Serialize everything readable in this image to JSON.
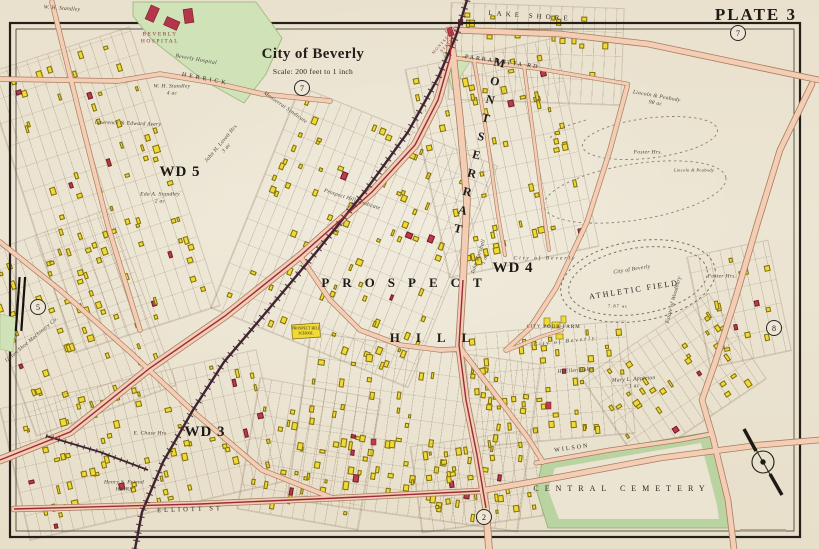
{
  "plate": {
    "label": "PLATE 3"
  },
  "title": {
    "name": "City of Beverly",
    "scale": "Scale: 200 feet to 1 inch"
  },
  "colors": {
    "paper": "#ece5d3",
    "road_fill": "#f3cdb4",
    "road_casing": "#a87d60",
    "building_wood": "#f1da33",
    "building_brick": "#bf3a4a",
    "park_green": "#cfe2b8",
    "cemetery_green": "#b9d4a0",
    "railroad": "#3f2430",
    "trolley": "#992b3d"
  },
  "plate_refs": [
    {
      "n": "7",
      "x": 738,
      "y": 33
    },
    {
      "n": "7",
      "x": 302,
      "y": 88
    },
    {
      "n": "5",
      "x": 38,
      "y": 307
    },
    {
      "n": "8",
      "x": 774,
      "y": 328
    },
    {
      "n": "2",
      "x": 484,
      "y": 517
    }
  ],
  "labels": {
    "districts": [
      {
        "t": "MONTSERRAT",
        "x": 478,
        "y": 148,
        "r": 14,
        "s": 12,
        "ls": 5,
        "v": true
      },
      {
        "t": "PROSPECT",
        "x": 408,
        "y": 283,
        "r": 0,
        "s": 13,
        "ls": 13
      },
      {
        "t": "HILL",
        "x": 438,
        "y": 338,
        "r": 0,
        "s": 13,
        "ls": 16
      }
    ],
    "wards": [
      {
        "t": "WD 5",
        "x": 180,
        "y": 172
      },
      {
        "t": "WD 4",
        "x": 513,
        "y": 268
      },
      {
        "t": "WD 3",
        "x": 205,
        "y": 432
      }
    ],
    "streets": [
      {
        "t": "LAKE SHORE",
        "x": 530,
        "y": 16,
        "r": 4,
        "s": 7,
        "ls": 4
      },
      {
        "t": "PARRAMATTA RD",
        "x": 502,
        "y": 63,
        "r": 8,
        "s": 6,
        "ls": 2
      },
      {
        "t": "HERRICK",
        "x": 205,
        "y": 80,
        "r": 11,
        "s": 6,
        "ls": 3
      },
      {
        "t": "ELLIOTT ST",
        "x": 190,
        "y": 510,
        "r": -2,
        "s": 6.5,
        "ls": 3
      },
      {
        "t": "WILSON",
        "x": 572,
        "y": 449,
        "r": -8,
        "s": 6,
        "ls": 2
      }
    ],
    "landmarks": [
      {
        "t": "BEVERLY\nHOSPITAL",
        "x": 160,
        "y": 38,
        "s": 5.5,
        "ls": 1.5,
        "red": true
      },
      {
        "t": "MONTSERRAT\nSTATION",
        "x": 447,
        "y": 41,
        "r": -48,
        "s": 4.2,
        "red": true
      },
      {
        "t": "CENTRAL  CEMETERY",
        "x": 622,
        "y": 489,
        "s": 8,
        "ls": 6
      },
      {
        "t": "CITY",
        "x": 534,
        "y": 326,
        "s": 4.5
      },
      {
        "t": "POOR FARM",
        "x": 562,
        "y": 328,
        "s": 5,
        "ls": 1
      },
      {
        "t": "ATHLETIC FIELD",
        "x": 634,
        "y": 290,
        "r": -9,
        "s": 8,
        "ls": 2
      },
      {
        "t": "PROSPECT HILL\nSCHOOL",
        "x": 306,
        "y": 331,
        "s": 3.8,
        "ls": 0
      },
      {
        "t": "7.87 ac",
        "x": 618,
        "y": 306,
        "s": 4.5
      }
    ],
    "owners": [
      {
        "t": "W. H. Standley",
        "x": 62,
        "y": 9,
        "r": 4
      },
      {
        "t": "W. H. Standley\n4 ac",
        "x": 172,
        "y": 90
      },
      {
        "t": "Beverly Hospital",
        "x": 196,
        "y": 60,
        "r": 10
      },
      {
        "t": "Lawrence & Edward Avery",
        "x": 128,
        "y": 124,
        "r": 2
      },
      {
        "t": "John H. Lovett Hrs\n3 ac",
        "x": 224,
        "y": 146,
        "r": -50
      },
      {
        "t": "Eda A. Standley\n2 ac",
        "x": 160,
        "y": 198
      },
      {
        "t": "Monserrat Syndicate",
        "x": 285,
        "y": 108,
        "r": 35
      },
      {
        "t": "Prospect Hill Syndicate",
        "x": 352,
        "y": 200,
        "r": 18
      },
      {
        "t": "John Marshall\n1 ac",
        "x": 482,
        "y": 258,
        "r": -72
      },
      {
        "t": "Lincoln & Peabody\n98 ac",
        "x": 656,
        "y": 100,
        "r": 10
      },
      {
        "t": "Foster Hrs.",
        "x": 648,
        "y": 153
      },
      {
        "t": "Lincoln & Peabody",
        "x": 694,
        "y": 170,
        "s": 4.5
      },
      {
        "t": "Foster Hrs.",
        "x": 722,
        "y": 277
      },
      {
        "t": "Estate of Woodbury",
        "x": 674,
        "y": 300,
        "r": -75
      },
      {
        "t": "City of Beverly",
        "x": 545,
        "y": 259,
        "ls": 2
      },
      {
        "t": "City of Beverly",
        "x": 632,
        "y": 270,
        "r": -9
      },
      {
        "t": "City  of  Beverly",
        "x": 565,
        "y": 342,
        "r": -6,
        "ls": 2
      },
      {
        "t": "H. Ellen Baker",
        "x": 576,
        "y": 371,
        "r": -4
      },
      {
        "t": "Mary L. Appleton\n1 ac",
        "x": 634,
        "y": 383,
        "r": -4
      },
      {
        "t": "Henry S. Friend\nHEIRS",
        "x": 124,
        "y": 486
      },
      {
        "t": "E. Chase Hrs",
        "x": 150,
        "y": 434
      },
      {
        "t": "Upton Shoe Machinery Co.",
        "x": 32,
        "y": 340,
        "r": -40
      }
    ]
  },
  "lot_clusters": [
    {
      "x": 26,
      "y": 44,
      "w": 152,
      "h": 292,
      "r": -18,
      "n": 62,
      "seed": 3
    },
    {
      "x": 0,
      "y": 228,
      "w": 148,
      "h": 188,
      "r": -20,
      "n": 46,
      "seed": 7
    },
    {
      "x": 12,
      "y": 378,
      "w": 262,
      "h": 134,
      "r": -13,
      "n": 62,
      "seed": 11
    },
    {
      "x": 248,
      "y": 118,
      "w": 212,
      "h": 238,
      "r": 22,
      "n": 76,
      "seed": 13
    },
    {
      "x": 298,
      "y": 348,
      "w": 232,
      "h": 168,
      "r": 8,
      "n": 66,
      "seed": 17
    },
    {
      "x": 426,
      "y": 52,
      "w": 152,
      "h": 212,
      "r": -12,
      "n": 52,
      "seed": 19
    },
    {
      "x": 468,
      "y": 328,
      "w": 162,
      "h": 112,
      "r": -5,
      "n": 42,
      "seed": 23
    },
    {
      "x": 598,
      "y": 328,
      "w": 152,
      "h": 102,
      "r": -34,
      "n": 30,
      "seed": 29
    },
    {
      "x": 416,
      "y": 438,
      "w": 126,
      "h": 86,
      "r": -8,
      "n": 28,
      "seed": 31
    },
    {
      "x": 698,
      "y": 248,
      "w": 82,
      "h": 112,
      "r": -12,
      "n": 14,
      "seed": 37
    },
    {
      "x": 450,
      "y": 6,
      "w": 172,
      "h": 96,
      "r": 2,
      "n": 18,
      "seed": 41
    },
    {
      "x": 248,
      "y": 388,
      "w": 122,
      "h": 132,
      "r": 10,
      "n": 26,
      "seed": 43
    }
  ]
}
